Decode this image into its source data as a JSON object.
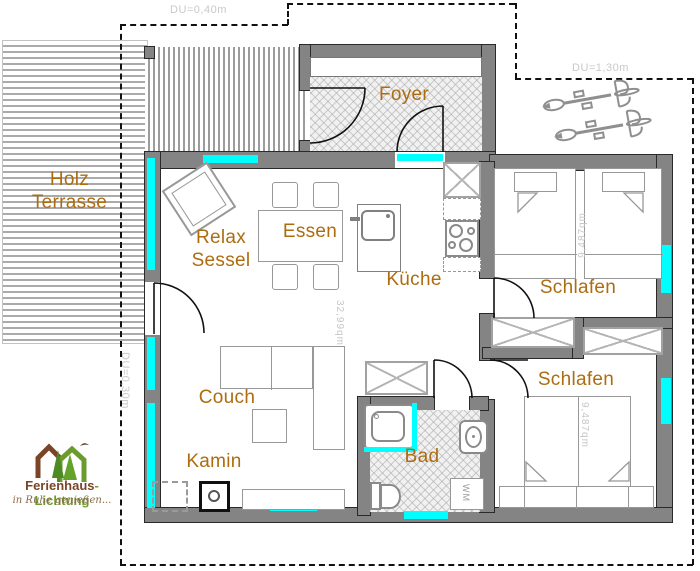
{
  "labels": {
    "terrace_line1": "Holz",
    "terrace_line2": "Terrasse",
    "foyer": "Foyer",
    "relax_line1": "Relax",
    "relax_line2": "Sessel",
    "dining": "Essen",
    "kitchen": "Küche",
    "bedroom_top": "Schlafen",
    "bedroom_bottom": "Schlafen",
    "couch": "Couch",
    "fireplace": "Kamin",
    "bath": "Bad",
    "washer": "WM"
  },
  "areas": {
    "living": "32,99qm",
    "bedroom_top": "9,487qm",
    "bedroom_bottom": "9,487qm"
  },
  "overhangs": {
    "top": "DU=0,40m",
    "right": "DU=1,30m",
    "left": "DU=0,30m"
  },
  "logo": {
    "brand_brown": "Ferienhaus",
    "brand_green": "-Lichtung",
    "tagline": "in Ruhe genießen..."
  },
  "colors": {
    "window_glazing": "#00ffff",
    "wall_fill": "#848484",
    "room_label": "#ad6c10",
    "faint_text": "#c9c9c9",
    "logo_brown": "#7a4527",
    "logo_green": "#6b9b2c"
  }
}
